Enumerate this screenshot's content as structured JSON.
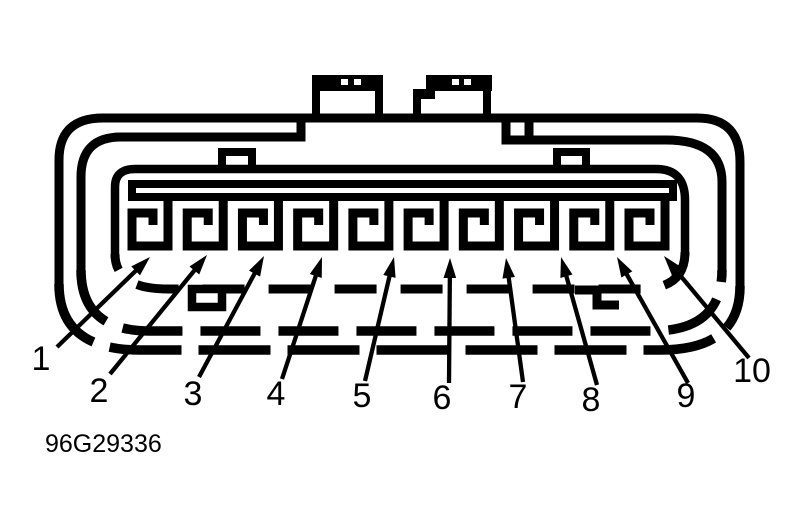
{
  "figure": {
    "caption": "96G29336",
    "kind": "10-pin connector face view diagram"
  },
  "colors": {
    "ink": "#000000",
    "paper": "#ffffff"
  },
  "connector": {
    "pin_count": 10,
    "pins": [
      {
        "label": "1"
      },
      {
        "label": "2"
      },
      {
        "label": "3"
      },
      {
        "label": "4"
      },
      {
        "label": "5"
      },
      {
        "label": "6"
      },
      {
        "label": "7"
      },
      {
        "label": "8"
      },
      {
        "label": "9"
      },
      {
        "label": "10"
      }
    ]
  }
}
